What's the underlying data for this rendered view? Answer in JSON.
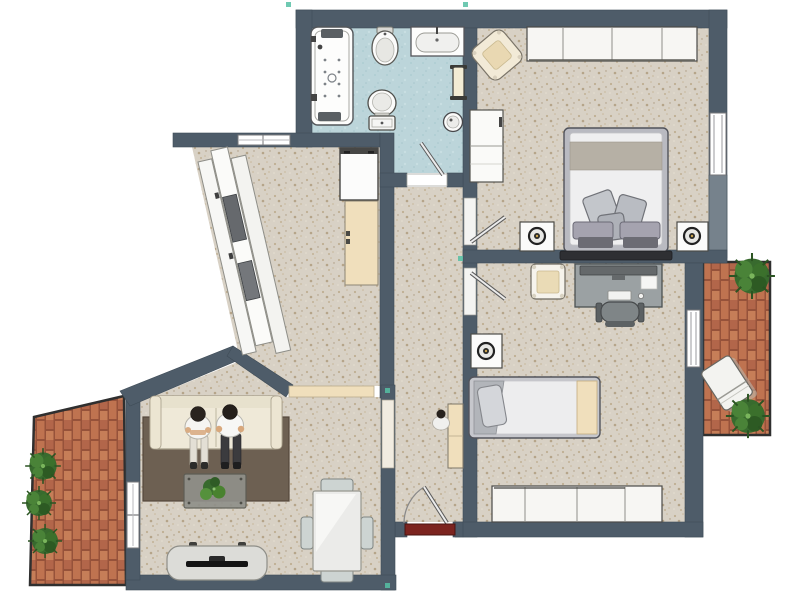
{
  "title": "apartment-floor-plan",
  "colors": {
    "wall": "#4e5c69",
    "wall_light": "#76828c",
    "floor_main": "#d8d1c5",
    "floor_bath": "#bcd5da",
    "brick": "#bf7350",
    "brick_alt": "#c67e58",
    "brick_dark": "#b2664a",
    "brick_mortar": "#96523a",
    "rug": "#6d6052",
    "sofa": "#efe9d8",
    "wood_beige": "#f0dfbc",
    "entrance_door": "#7c241f",
    "desk_gray": "#9ba1a3",
    "plant": "#386a2e",
    "marker": "#56c0a4",
    "fixture_white": "#fbfbfa"
  },
  "rooms": [
    {
      "id": "bathroom",
      "floor": "light-blue-tile",
      "items": [
        "whirlpool-bathtub",
        "bidet",
        "washbasin",
        "toilet",
        "towel-radiator",
        "corner-washbasin",
        "door"
      ]
    },
    {
      "id": "bedroom",
      "floor": "beige-carpet",
      "items": [
        "wardrobe-4-sections",
        "armchair",
        "dresser",
        "double-bed",
        "nightstand-with-lamp",
        "nightstand-with-lamp",
        "window",
        "door"
      ]
    },
    {
      "id": "office-bedroom",
      "floor": "beige-carpet",
      "items": [
        "desk-with-monitor",
        "office-chair",
        "side-chair",
        "nightstand-with-lamp",
        "single-bed",
        "wardrobe-4-sections",
        "window-to-balcony",
        "door"
      ]
    },
    {
      "id": "kitchen",
      "floor": "beige-carpet",
      "items": [
        "diagonal-counter",
        "cooktop",
        "appliance",
        "fridge",
        "tall-cabinet",
        "window"
      ]
    },
    {
      "id": "living-room",
      "floor": "beige-carpet",
      "items": [
        "sofa",
        "two-people-sitting",
        "area-rug",
        "coffee-table-with-plant",
        "tv-stand",
        "dining-table",
        "four-chairs",
        "window",
        "open-passage"
      ]
    },
    {
      "id": "hallway",
      "floor": "beige-carpet",
      "items": [
        "coat-closet",
        "person-figure",
        "entrance-door-with-swing"
      ]
    },
    {
      "id": "balcony-right",
      "floor": "terracotta-brick",
      "items": [
        "sun-lounger",
        "plant",
        "plant"
      ]
    },
    {
      "id": "balcony-left",
      "floor": "terracotta-brick",
      "items": [
        "plant",
        "plant",
        "plant"
      ]
    }
  ],
  "counts": {
    "rooms": 6,
    "balconies": 2,
    "interior-doors": 3,
    "entrance-doors": 1,
    "windows": 5,
    "people": 3
  }
}
